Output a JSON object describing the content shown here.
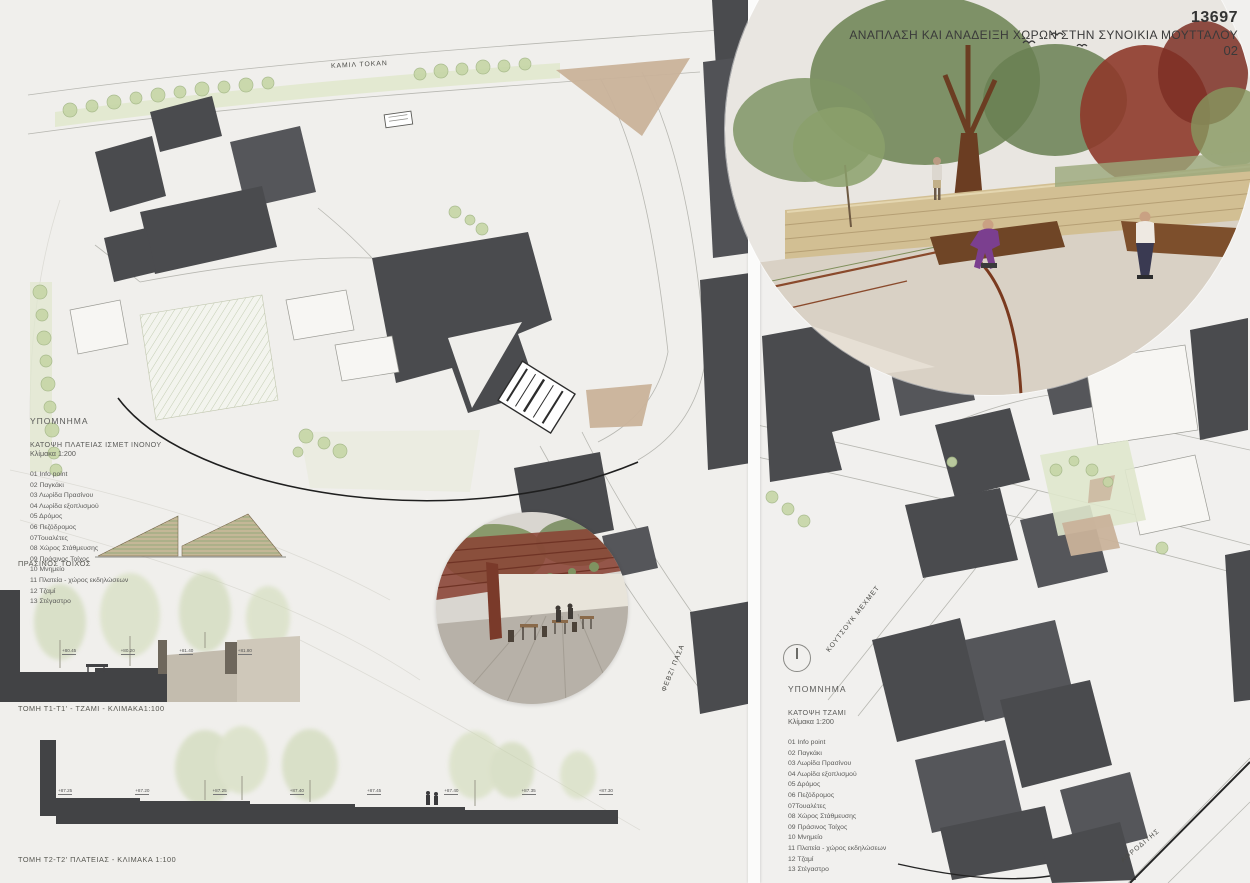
{
  "titleblock": {
    "number": "13697",
    "title": "ΑΝΑΠΛΑΣΗ ΚΑΙ ΑΝΑΔΕΙΞΗ ΧΩΡΩΝ ΣΤΗΝ ΣΥΝΟΙΚΙΑ ΜΟΥΤΤΑΛΟΥ",
    "page": "02"
  },
  "legend_left": {
    "heading": "ΥΠΟΜΝΗΜΑ",
    "subtitle": "ΚΑΤΟΨΗ ΠΛΑΤΕΙΑΣ ΙΣΜΕΤ ΙΝΟΝΟΥ",
    "scale": "Κλίμακα 1:200",
    "items": [
      "01 Info point",
      "02 Παγκάκι",
      "03 Λωρίδα Πρασίνου",
      "04 Λωρίδα εξοπλισμού",
      "05 Δρόμος",
      "06 Πεζόδρομος",
      "07Τουαλέτες",
      "08 Χώρος Στάθμευσης",
      "09 Πράσινος Τοίχος",
      "10 Μνημείο",
      "11 Πλατεία - χώρος εκδηλώσεων",
      "12 Τζαμί",
      "13 Στέγαστρο"
    ]
  },
  "legend_right": {
    "heading": "ΥΠΟΜΝΗΜΑ",
    "subtitle": "ΚΑΤΟΨΗ ΤΖΑΜΙ",
    "scale": "Κλίμακα 1:200",
    "items": [
      "01 Info point",
      "02 Παγκάκι",
      "03 Λωρίδα Πρασίνου",
      "04 Λωρίδα εξοπλισμού",
      "05 Δρόμος",
      "06 Πεζόδρομος",
      "07Τουαλέτες",
      "08 Χώρος Στάθμευσης",
      "09 Πράσινος Τοίχος",
      "10 Μνημείο",
      "11 Πλατεία - χώρος εκδηλώσεων",
      "12 Τζαμί",
      "13 Στέγαστρο"
    ]
  },
  "labels": {
    "green_wall": "ΠΡΑΣΙΝΟΣ ΤΟΙΧΟΣ",
    "section_t1": "ΤΟΜΗ Τ1-Τ1' - ΤΖΑΜΙ - ΚΛΙΜΑΚΑ1:100",
    "section_t2": "ΤΟΜΗ Τ2-Τ2' ΠΛΑΤΕΙΑΣ - ΚΛΙΜΑΚΑ 1:100"
  },
  "streets": {
    "kamil_tokan": "ΚΑΜΙΛ ΤΟΚΑΝ",
    "koutsouk_mehmet": "ΚΟΥΤΣΟΥΚ ΜΕΧΜΕΤ",
    "fevzi_pasa": "ΦΕΒΖΙ ΠΑΣΑ",
    "afroditis": "ΑΦΡΟΔΙΤΗΣ"
  },
  "sections": {
    "t1_elevations": [
      "+80.45",
      "+80.20",
      "+81.40",
      "+81.80"
    ],
    "t2_elevations": [
      "+87.25",
      "+87.20",
      "+87.25",
      "+87.40",
      "+87.45",
      "+87.40",
      "+87.35",
      "+87.30"
    ]
  },
  "icons": {
    "north_arrow": "circle-with-needle",
    "birds": "bird-strokes"
  },
  "colors": {
    "building": "#4a4b4e",
    "section_poche": "#424345",
    "green_strip": "#ccd8b2",
    "tan_patch": "#c9b29a",
    "accent_corten": "#8a4a2c",
    "accent_red_tree": "#8e3a2b",
    "text": "#3d3d3d"
  }
}
